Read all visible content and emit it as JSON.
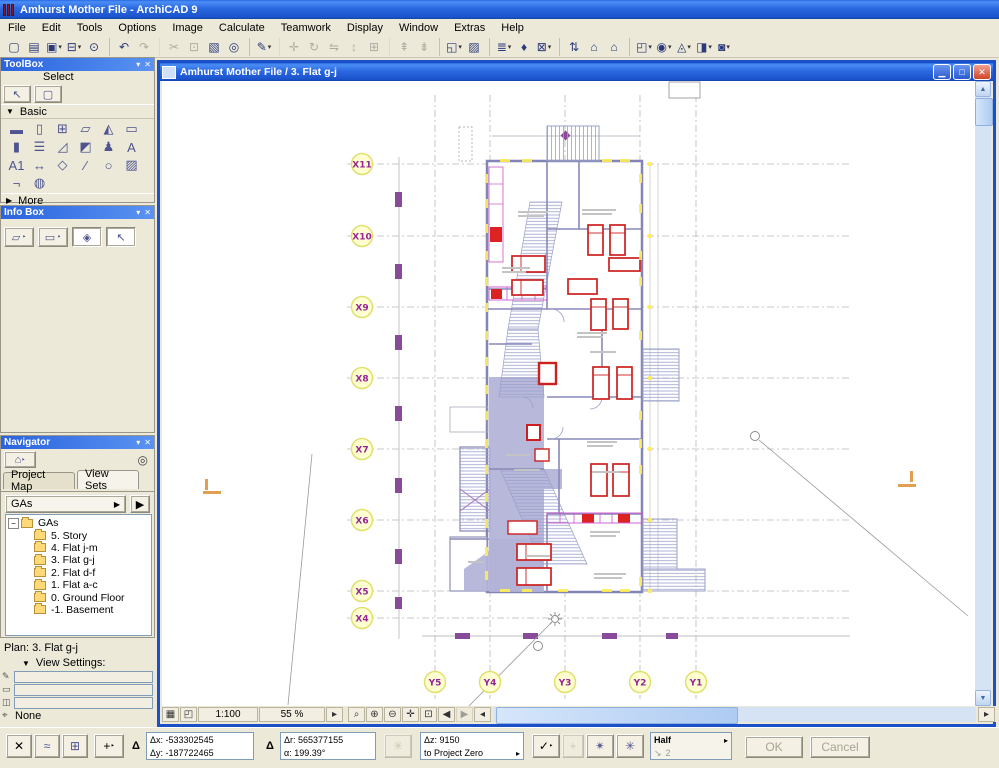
{
  "app": {
    "title": "Amhurst Mother File - ArchiCAD 9"
  },
  "menu": {
    "items": [
      "File",
      "Edit",
      "Tools",
      "Options",
      "Image",
      "Calculate",
      "Teamwork",
      "Display",
      "Window",
      "Extras",
      "Help"
    ]
  },
  "toolbar": {
    "items": [
      {
        "name": "new-button",
        "glyph": "▢"
      },
      {
        "name": "open-button",
        "glyph": "▤"
      },
      {
        "name": "save-button",
        "glyph": "▣",
        "dd": true
      },
      {
        "name": "print-button",
        "glyph": "⊟",
        "dd": true
      },
      {
        "name": "find-change-button",
        "glyph": "⊙"
      },
      {
        "name": "undo-button",
        "glyph": "↶",
        "sep": true
      },
      {
        "name": "redo-button",
        "glyph": "↷",
        "disabled": true
      },
      {
        "name": "cut-button",
        "glyph": "✂",
        "disabled": true,
        "sep": true
      },
      {
        "name": "copy-button",
        "glyph": "⊡",
        "disabled": true
      },
      {
        "name": "paste-button",
        "glyph": "▧"
      },
      {
        "name": "find-select-button",
        "glyph": "◎"
      },
      {
        "name": "pen-settings-button",
        "glyph": "✎",
        "dd": true,
        "sep": true
      },
      {
        "name": "drag-button",
        "glyph": "✛",
        "disabled": true,
        "sep": true
      },
      {
        "name": "rotate-button",
        "glyph": "↻",
        "disabled": true
      },
      {
        "name": "mirror-button",
        "glyph": "⇋",
        "disabled": true
      },
      {
        "name": "elevate-button",
        "glyph": "↕",
        "disabled": true
      },
      {
        "name": "multiply-button",
        "glyph": "⊞",
        "disabled": true
      },
      {
        "name": "pickup-params-button",
        "glyph": "⇞",
        "disabled": true,
        "sep": true
      },
      {
        "name": "inject-params-button",
        "glyph": "⇟",
        "disabled": true
      },
      {
        "name": "window-options-button",
        "glyph": "◱",
        "dd": true,
        "sep": true
      },
      {
        "name": "hatch-toggle-button",
        "glyph": "▨"
      },
      {
        "name": "layers-button",
        "glyph": "≣",
        "dd": true,
        "sep": true
      },
      {
        "name": "pen-color-button",
        "glyph": "♦"
      },
      {
        "name": "element-settings-button",
        "glyph": "⊠",
        "dd": true
      },
      {
        "name": "navigate-button",
        "glyph": "⇅",
        "sep": true
      },
      {
        "name": "go-up-story-button",
        "glyph": "⌂"
      },
      {
        "name": "go-down-story-button",
        "glyph": "⌂"
      },
      {
        "name": "display-option-1-button",
        "glyph": "◰",
        "dd": true,
        "sep": true
      },
      {
        "name": "display-option-2-button",
        "glyph": "◉",
        "dd": true
      },
      {
        "name": "display-option-3-button",
        "glyph": "◬",
        "dd": true
      },
      {
        "name": "display-option-4-button",
        "glyph": "◨",
        "dd": true
      },
      {
        "name": "camera-button",
        "glyph": "◙",
        "dd": true
      }
    ]
  },
  "toolbox": {
    "title": "ToolBox",
    "select_label": "Select",
    "basic_label": "Basic",
    "more_label": "More",
    "select_tools": [
      {
        "name": "arrow-tool",
        "glyph": "↖"
      },
      {
        "name": "marquee-tool",
        "glyph": "▢"
      }
    ],
    "basic_tools": [
      {
        "name": "wall-tool",
        "glyph": "▬"
      },
      {
        "name": "door-tool",
        "glyph": "▯"
      },
      {
        "name": "window-tool",
        "glyph": "⊞"
      },
      {
        "name": "slab-tool",
        "glyph": "▱"
      },
      {
        "name": "roof-tool",
        "glyph": "◭"
      },
      {
        "name": "beam-tool",
        "glyph": "▭"
      },
      {
        "name": "column-tool",
        "glyph": "▮"
      },
      {
        "name": "stair-tool",
        "glyph": "☰"
      },
      {
        "name": "mesh-tool",
        "glyph": "◿"
      },
      {
        "name": "zone-tool",
        "glyph": "◩"
      },
      {
        "name": "object-tool",
        "glyph": "♟"
      },
      {
        "name": "text-tool",
        "glyph": "A"
      },
      {
        "name": "label-tool",
        "glyph": "A1"
      },
      {
        "name": "dimension-tool",
        "glyph": "↔"
      },
      {
        "name": "level-dimension-tool",
        "glyph": "◇"
      },
      {
        "name": "line-tool",
        "glyph": "∕"
      },
      {
        "name": "arc-tool",
        "glyph": "○"
      },
      {
        "name": "fill-tool",
        "glyph": "▨"
      },
      {
        "name": "section-tool",
        "glyph": "¬"
      },
      {
        "name": "detail-tool",
        "glyph": "◍"
      }
    ]
  },
  "infobox": {
    "title": "Info Box",
    "buttons": [
      {
        "name": "marquee-poly-button",
        "glyph": "▱",
        "dd": true
      },
      {
        "name": "marquee-rect-button",
        "glyph": "▭",
        "dd": true
      },
      {
        "name": "rotate-marquee-button",
        "glyph": "◈",
        "pressed": true
      },
      {
        "name": "arrow-mode-button",
        "glyph": "↖",
        "pressed": true
      }
    ]
  },
  "navigator": {
    "title": "Navigator",
    "tabs": [
      "Project Map",
      "View Sets"
    ],
    "dropdown_value": "GAs",
    "tree_root": "GAs",
    "tree_items": [
      {
        "label": "5. Story"
      },
      {
        "label": "4. Flat j-m"
      },
      {
        "label": "3. Flat g-j"
      },
      {
        "label": "2. Flat d-f"
      },
      {
        "label": "1. Flat a-c"
      },
      {
        "label": "0. Ground Floor"
      },
      {
        "label": "-1. Basement"
      }
    ],
    "plan_status": "Plan: 3. Flat g-j",
    "view_settings_label": "View Settings:",
    "zoom_setting": "None"
  },
  "document": {
    "title": "Amhurst Mother File / 3. Flat g-j",
    "scale": "1:100",
    "zoom": "55 %"
  },
  "plan": {
    "x_labels": [
      "X11",
      "X10",
      "X9",
      "X8",
      "X7",
      "X6",
      "X5",
      "X4"
    ],
    "y_labels": [
      "Y5",
      "Y4",
      "Y3",
      "Y2",
      "Y1"
    ]
  },
  "statusbar": {
    "dx_label": "Δx:",
    "dx_value": "-533302545",
    "dy_label": "Δy:",
    "dy_value": "-187722465",
    "dr_label": "Δr:",
    "dr_value": "565377155",
    "a_label": "α:",
    "a_value": "199.39°",
    "dz_label": "Δz:",
    "dz_value": "9150",
    "reference": "to Project Zero",
    "grid_snap_label": "Half",
    "grid_snap_value": "2",
    "ok_label": "OK",
    "cancel_label": "Cancel"
  },
  "colors": {
    "wall": "#8585b5",
    "furniture_red": "#cc2020",
    "corridor_fill": "#b2b2d8",
    "grid_bubble_text": "#992299",
    "window_yellow": "#ffee55",
    "titlebar_blue": "#2a68e0"
  }
}
